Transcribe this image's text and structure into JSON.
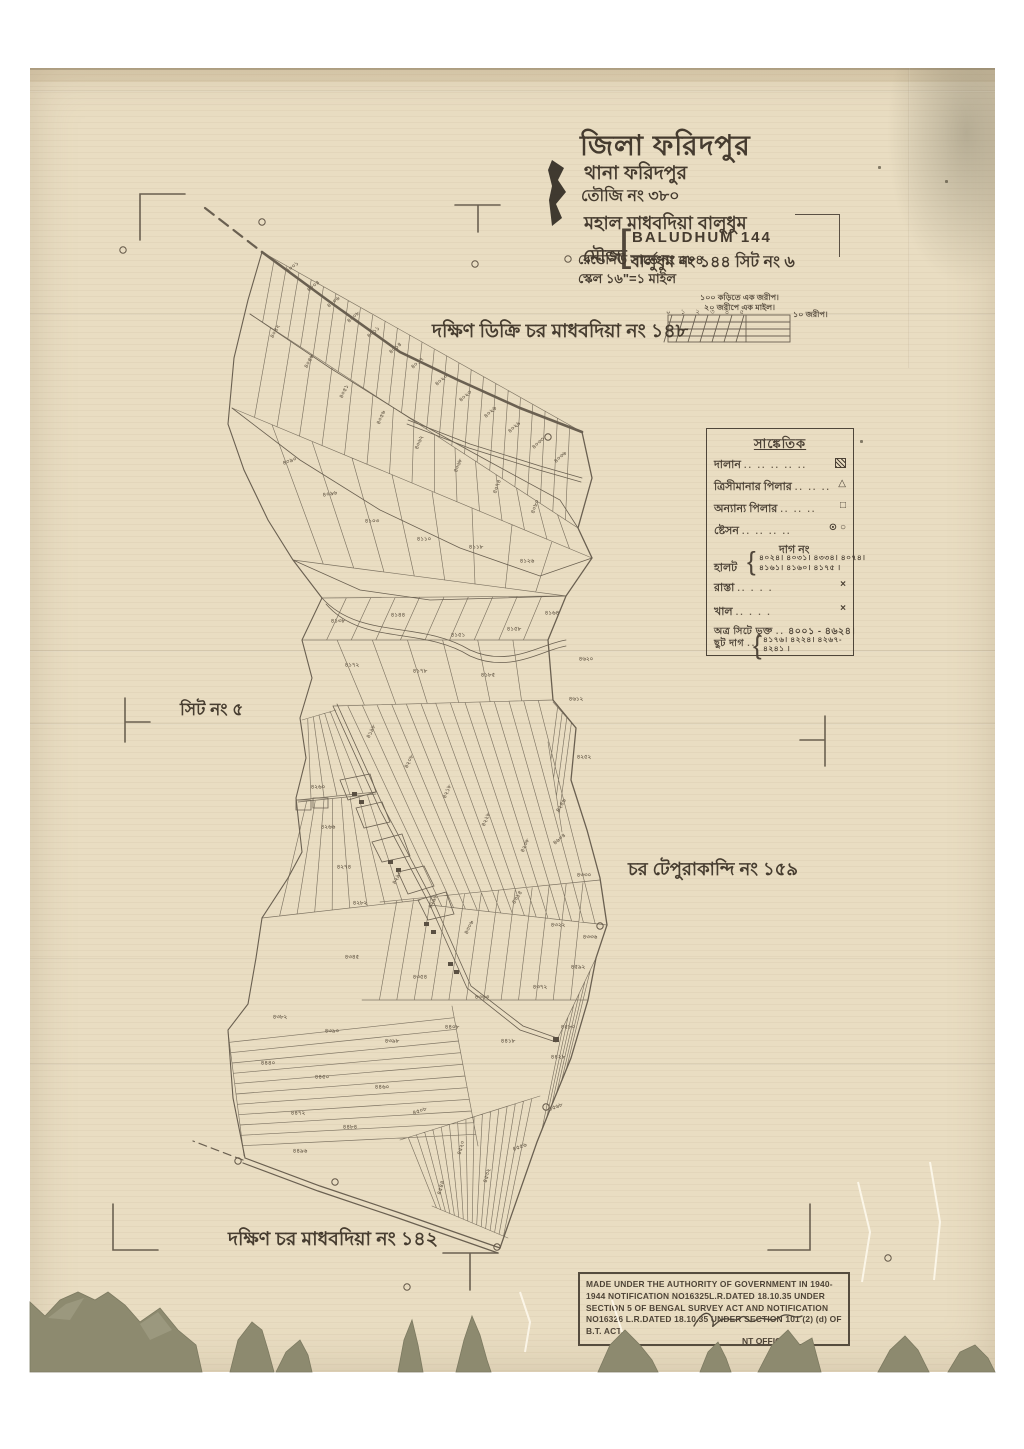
{
  "colors": {
    "paper": "#e9ddc2",
    "ink": "#4d4337",
    "map_line": "#5f5546",
    "torn": "#8d8a6f",
    "white": "#ffffff"
  },
  "title_block": {
    "district": "জিলা ফরিদপুর",
    "thana": "থানা ফরিদপুর",
    "touzi": "তৌজি নং ৩৮০",
    "mahal": "মহাল মাধবদিয়া বালুধুম",
    "mouza_label": "মৌজা",
    "bracket": "[",
    "mouza_en": "BALUDHUM 144",
    "mouza_bn": "বালুধুম নং ১৪৪ সিট নং ৬",
    "revenue": "রেভেনিউ সার্ভে নং ৫৮৪",
    "scale": "স্কেল ১৬\"=১ মাইল"
  },
  "scale_bar": {
    "line1": "১০০ কড়িতে এক জরীপ।",
    "line2": "২০ জরীপে এক মাইল।",
    "ticks": [
      "০",
      "১",
      "২",
      "৩",
      "৪",
      "৫"
    ],
    "right_label": "১০ জরীপ।"
  },
  "region_labels": {
    "north": "দক্ষিণ ডিক্রি চর মাধবদিয়া নং ১৪৮",
    "west": "সিট নং ৫",
    "east": "চর টেপুরাকান্দি নং ১৫৯",
    "south": "দক্ষিণ চর মাধবদিয়া নং ১৪২"
  },
  "legend": {
    "header": "সাঙ্কেতিক",
    "rows": [
      {
        "label": "দালান",
        "dots": ".. .. .. .. ..",
        "symbol": "building"
      },
      {
        "label": "ত্রিসীমানার পিলার",
        "dots": ".. .. ..",
        "symbol": "triangle"
      },
      {
        "label": "অন্যান্য পিলার",
        "dots": ".. .. ..",
        "symbol": "square"
      },
      {
        "label": "ষ্টেসন",
        "dots": ".. .. .. ..",
        "symbol": "circles"
      }
    ],
    "symbols": {
      "triangle": "△",
      "square": "□",
      "circles": "⊙ ○",
      "cross": "×"
    },
    "dag_no_header": "দাগ নং",
    "halot_label": "হালট",
    "halot_values_1": "৪০২৪। ৪০৩১। ৪৩৩৪। ৪০৭৪।",
    "halot_values_2": "৪১৬১। ৪১৬০। ৪১৭৫ ।",
    "rasta_label": "রাস্তা",
    "rasta_dots": "..      . . .",
    "khal_label": "খাল",
    "khal_dots": "..      . . .",
    "sheet_label": "অত্র সিটে ভুক্ত",
    "sheet_values": "৪০০১ - ৪৬২৪।",
    "chhut_label": "ছুট দাগ",
    "chhut_dots": "...",
    "chhut_values_1": "৪১৭৬। ৪২২৪। ৪২৬৭-",
    "chhut_values_2": "৪২৪১ ।"
  },
  "stamp": {
    "line1": "MADE UNDER THE AUTHORITY OF GOVERNMENT IN 1940-1944 NOTIFICATION",
    "line2": "NO16325L.R.DATED 18.10.35 UNDER SECTION 5 OF BENGAL SURVEY ACT AND",
    "line3": "NOTIFICATION NO16326 L.R.DATED 18.10.35 UNDER SECTION 101 (2) (d) OF",
    "line4": "B.T. ACT.",
    "officer": "NT OFFICER."
  },
  "stations": [
    [
      123,
      250
    ],
    [
      262,
      222
    ],
    [
      475,
      264
    ],
    [
      568,
      259
    ],
    [
      548,
      437
    ],
    [
      600,
      926
    ],
    [
      546,
      1107
    ],
    [
      238,
      1161
    ],
    [
      335,
      1182
    ],
    [
      497,
      1247
    ],
    [
      407,
      1287
    ],
    [
      888,
      1258
    ]
  ],
  "plot_labels": [
    {
      "t": "৪০০১",
      "x": 293,
      "y": 268,
      "r": -38
    },
    {
      "t": "৪০০৪",
      "x": 314,
      "y": 287,
      "r": -38
    },
    {
      "t": "৪০০৬",
      "x": 334,
      "y": 303,
      "r": -38
    },
    {
      "t": "৪০০৮",
      "x": 354,
      "y": 318,
      "r": -40
    },
    {
      "t": "৪০১১",
      "x": 374,
      "y": 333,
      "r": -40
    },
    {
      "t": "৪০১৪",
      "x": 396,
      "y": 349,
      "r": -40
    },
    {
      "t": "৪০১৭",
      "x": 418,
      "y": 364,
      "r": -40
    },
    {
      "t": "৪০২০",
      "x": 442,
      "y": 381,
      "r": -40
    },
    {
      "t": "৪০২৩",
      "x": 466,
      "y": 397,
      "r": -40
    },
    {
      "t": "৪০২৬",
      "x": 491,
      "y": 413,
      "r": -42
    },
    {
      "t": "৪০২৯",
      "x": 515,
      "y": 428,
      "r": -42
    },
    {
      "t": "৪০৩৩",
      "x": 539,
      "y": 444,
      "r": -42
    },
    {
      "t": "৪০৩৬",
      "x": 561,
      "y": 458,
      "r": -42
    },
    {
      "t": "৪০৪২",
      "x": 276,
      "y": 332,
      "r": -62
    },
    {
      "t": "৪০৪৬",
      "x": 310,
      "y": 362,
      "r": -62
    },
    {
      "t": "৪০৫১",
      "x": 345,
      "y": 392,
      "r": -64
    },
    {
      "t": "৪০৫৬",
      "x": 382,
      "y": 418,
      "r": -66
    },
    {
      "t": "৪০৬২",
      "x": 420,
      "y": 443,
      "r": -68
    },
    {
      "t": "৪০৬৮",
      "x": 459,
      "y": 466,
      "r": -68
    },
    {
      "t": "৪০৭৪",
      "x": 498,
      "y": 487,
      "r": -70
    },
    {
      "t": "৪০৮০",
      "x": 536,
      "y": 507,
      "r": -70
    },
    {
      "t": "৪০৯০",
      "x": 290,
      "y": 462,
      "r": -20
    },
    {
      "t": "৪০৯৬",
      "x": 330,
      "y": 495,
      "r": -10
    },
    {
      "t": "৪১০৩",
      "x": 372,
      "y": 522,
      "r": 0
    },
    {
      "t": "৪১১০",
      "x": 424,
      "y": 540,
      "r": 0
    },
    {
      "t": "৪১১৮",
      "x": 476,
      "y": 548,
      "r": 0
    },
    {
      "t": "৪১২৬",
      "x": 527,
      "y": 562,
      "r": 0
    },
    {
      "t": "৪১৩৮",
      "x": 338,
      "y": 622,
      "r": 0
    },
    {
      "t": "৪১৪৪",
      "x": 398,
      "y": 616,
      "r": 0
    },
    {
      "t": "৪১৫১",
      "x": 458,
      "y": 636,
      "r": 0
    },
    {
      "t": "৪১৫৮",
      "x": 514,
      "y": 630,
      "r": 0
    },
    {
      "t": "৪১৬৪",
      "x": 552,
      "y": 614,
      "r": 0
    },
    {
      "t": "৪১৭২",
      "x": 352,
      "y": 666,
      "r": 0
    },
    {
      "t": "৪১৭৮",
      "x": 420,
      "y": 672,
      "r": 0
    },
    {
      "t": "৪১৮৫",
      "x": 488,
      "y": 676,
      "r": 0
    },
    {
      "t": "৪১৯৮",
      "x": 372,
      "y": 732,
      "r": -64
    },
    {
      "t": "৪২০৮",
      "x": 410,
      "y": 762,
      "r": -64
    },
    {
      "t": "৪২১৮",
      "x": 448,
      "y": 792,
      "r": -66
    },
    {
      "t": "৪২২৮",
      "x": 487,
      "y": 820,
      "r": -66
    },
    {
      "t": "৪২৩৮",
      "x": 526,
      "y": 846,
      "r": -66
    },
    {
      "t": "৪২৪৬",
      "x": 562,
      "y": 806,
      "r": -60
    },
    {
      "t": "৪২৫২",
      "x": 584,
      "y": 758,
      "r": 0
    },
    {
      "t": "৪২৬০",
      "x": 318,
      "y": 788,
      "r": 0
    },
    {
      "t": "৪২৬৬",
      "x": 328,
      "y": 828,
      "r": 0
    },
    {
      "t": "৪২৭৪",
      "x": 344,
      "y": 868,
      "r": 0
    },
    {
      "t": "৪২৮২",
      "x": 360,
      "y": 904,
      "r": 0
    },
    {
      "t": "৪২৯০",
      "x": 398,
      "y": 878,
      "r": -64
    },
    {
      "t": "৪২৯৮",
      "x": 434,
      "y": 902,
      "r": -64
    },
    {
      "t": "৪৩০৬",
      "x": 470,
      "y": 928,
      "r": -64
    },
    {
      "t": "৪৩১৪",
      "x": 518,
      "y": 898,
      "r": -58
    },
    {
      "t": "৪৩২২",
      "x": 558,
      "y": 926,
      "r": 0
    },
    {
      "t": "৪৩৩০",
      "x": 584,
      "y": 876,
      "r": 0
    },
    {
      "t": "৪৩৩৬",
      "x": 590,
      "y": 938,
      "r": 0
    },
    {
      "t": "৪৩৪৫",
      "x": 352,
      "y": 958,
      "r": 0
    },
    {
      "t": "৪৩৫৪",
      "x": 420,
      "y": 978,
      "r": 0
    },
    {
      "t": "৪৩৬৩",
      "x": 482,
      "y": 998,
      "r": 0
    },
    {
      "t": "৪৩৭২",
      "x": 540,
      "y": 988,
      "r": 0
    },
    {
      "t": "৪৩৮২",
      "x": 280,
      "y": 1018,
      "r": 0
    },
    {
      "t": "৪৩৯০",
      "x": 332,
      "y": 1032,
      "r": 0
    },
    {
      "t": "৪৩৯৮",
      "x": 392,
      "y": 1042,
      "r": 0
    },
    {
      "t": "৪৪০৮",
      "x": 452,
      "y": 1028,
      "r": 0
    },
    {
      "t": "৪৪১৮",
      "x": 508,
      "y": 1042,
      "r": 0
    },
    {
      "t": "৪৪২৮",
      "x": 558,
      "y": 1058,
      "r": 0
    },
    {
      "t": "৪৪৪০",
      "x": 268,
      "y": 1064,
      "r": 0
    },
    {
      "t": "৪৪৫০",
      "x": 322,
      "y": 1078,
      "r": 0
    },
    {
      "t": "৪৪৬০",
      "x": 382,
      "y": 1088,
      "r": 0
    },
    {
      "t": "৪৪৭২",
      "x": 298,
      "y": 1114,
      "r": 0
    },
    {
      "t": "৪৪৮৪",
      "x": 350,
      "y": 1128,
      "r": 0
    },
    {
      "t": "৪৪৯৬",
      "x": 300,
      "y": 1152,
      "r": 0
    },
    {
      "t": "৪৫০৮",
      "x": 420,
      "y": 1112,
      "r": -18
    },
    {
      "t": "৪৫২০",
      "x": 462,
      "y": 1148,
      "r": -74
    },
    {
      "t": "৪৫৩২",
      "x": 488,
      "y": 1176,
      "r": -74
    },
    {
      "t": "৪৫৪৪",
      "x": 442,
      "y": 1188,
      "r": -74
    },
    {
      "t": "৪৫৫৬",
      "x": 520,
      "y": 1148,
      "r": -20
    },
    {
      "t": "৪৫৬৮",
      "x": 556,
      "y": 1108,
      "r": -20
    },
    {
      "t": "৪৫৮০",
      "x": 568,
      "y": 1028,
      "r": 0
    },
    {
      "t": "৪৫৯২",
      "x": 578,
      "y": 968,
      "r": 0
    },
    {
      "t": "৪৬০৪",
      "x": 560,
      "y": 840,
      "r": -40
    },
    {
      "t": "৪৬১২",
      "x": 576,
      "y": 700,
      "r": 0
    },
    {
      "t": "৪৬২০",
      "x": 586,
      "y": 660,
      "r": 0
    }
  ]
}
